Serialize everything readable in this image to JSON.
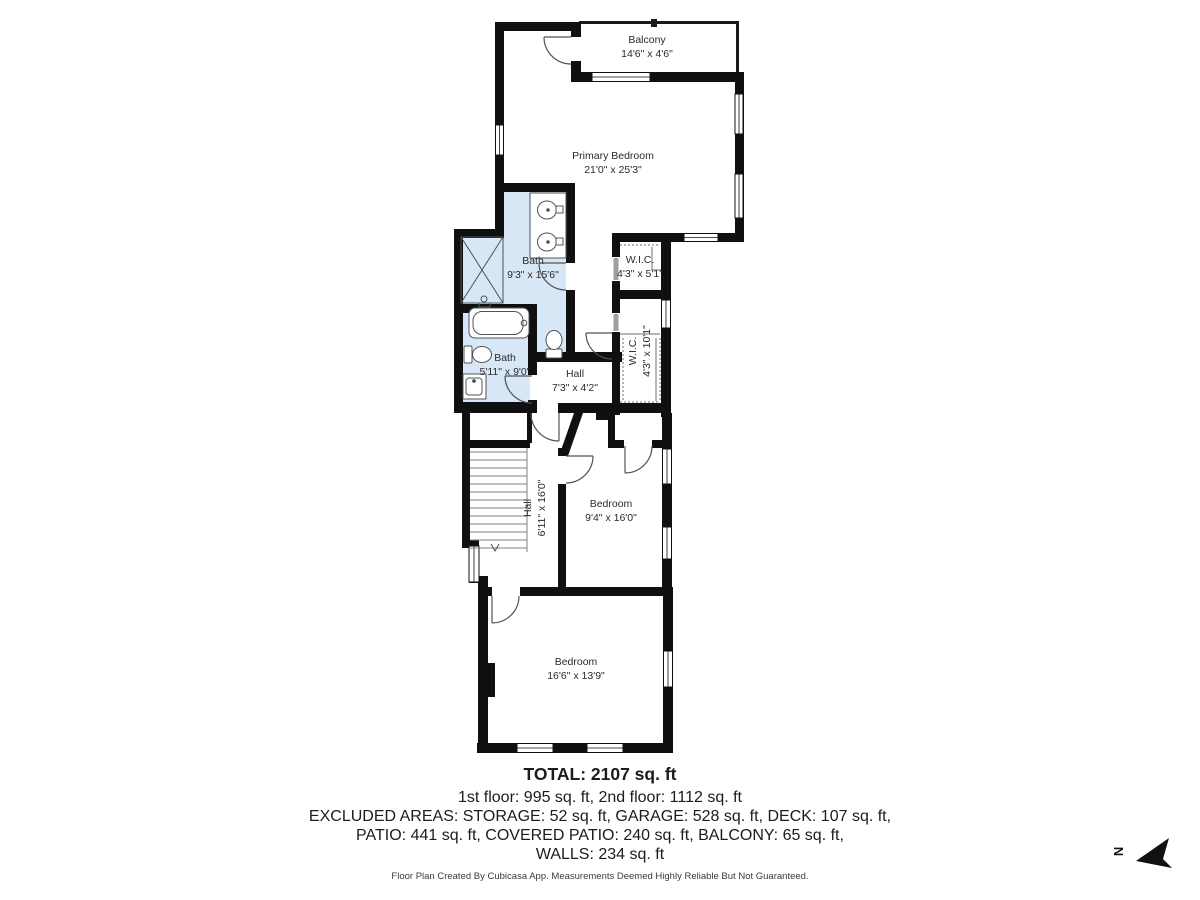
{
  "rooms": [
    {
      "name": "Balcony",
      "dims": "14'6\" x 4'6\""
    },
    {
      "name": "Primary Bedroom",
      "dims": "21'0\" x 25'3\""
    },
    {
      "name": "Bath",
      "dims": "9'3\" x 15'6\""
    },
    {
      "name": "W.I.C.",
      "dims": "4'3\" x 5'1\""
    },
    {
      "name": "W.I.C.",
      "dims": "4'3\" x 10'1\""
    },
    {
      "name": "Bath",
      "dims": "5'11\" x 9'0\""
    },
    {
      "name": "Hall",
      "dims": "7'3\" x 4'2\""
    },
    {
      "name": "Hall",
      "dims": "6'11\" x 16'0\""
    },
    {
      "name": "Bedroom",
      "dims": "9'4\" x 16'0\""
    },
    {
      "name": "Bedroom",
      "dims": "16'6\" x 13'9\""
    }
  ],
  "summary": {
    "total": "TOTAL: 2107 sq. ft",
    "floors": "1st floor: 995 sq. ft, 2nd floor: 1112 sq. ft",
    "excluded_line1": "EXCLUDED AREAS: STORAGE: 52 sq. ft, GARAGE: 528 sq. ft, DECK: 107 sq. ft,",
    "excluded_line2": "PATIO: 441 sq. ft, COVERED PATIO: 240 sq. ft, BALCONY: 65 sq. ft,",
    "excluded_line3": "WALLS: 234 sq. ft"
  },
  "footer": "Floor Plan Created By Cubicasa App. Measurements Deemed Highly Reliable But Not Guaranteed.",
  "compass": {
    "label": "N"
  },
  "colors": {
    "wall": "#101010",
    "bath_fill": "#d8e7f6",
    "fixture_stroke": "#4f5357"
  }
}
